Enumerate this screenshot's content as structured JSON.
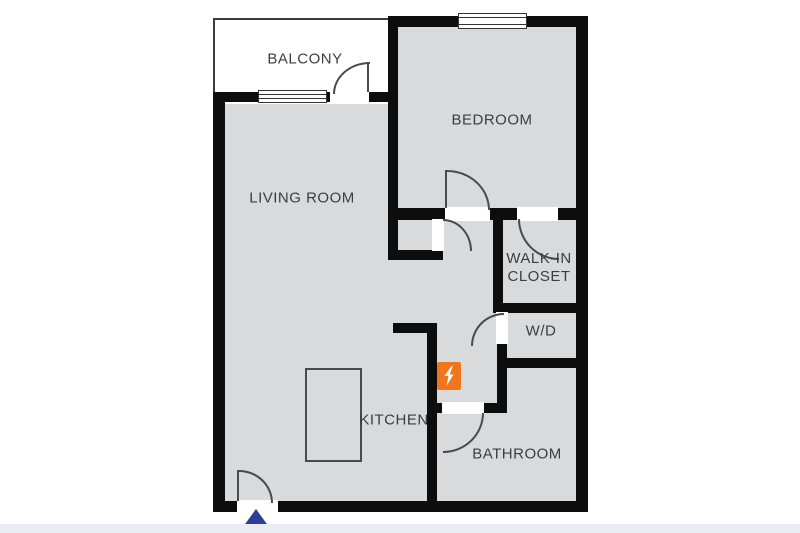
{
  "rooms": {
    "balcony": "BALCONY",
    "bedroom": "BEDROOM",
    "living_room": "LIVING ROOM",
    "walk_in_closet_line1": "WALK-IN",
    "walk_in_closet_line2": "CLOSET",
    "washer_dryer": "W/D",
    "kitchen": "KITCHEN",
    "bathroom": "BATHROOM"
  },
  "icons": {
    "electrical_panel": "lightning-bolt-icon",
    "entrance_marker": "triangle-up-marker"
  },
  "colors": {
    "floor": "#d9dadc",
    "wall": "#0d0d0d",
    "balcony_floor": "#ffffff",
    "electrical_panel_orange": "#f0751c",
    "entrance_marker_navy": "#2e3d96",
    "label_text": "#3d3d3d",
    "thin_line": "#4a4a4a",
    "bottom_strip": "#e9ecf2"
  }
}
